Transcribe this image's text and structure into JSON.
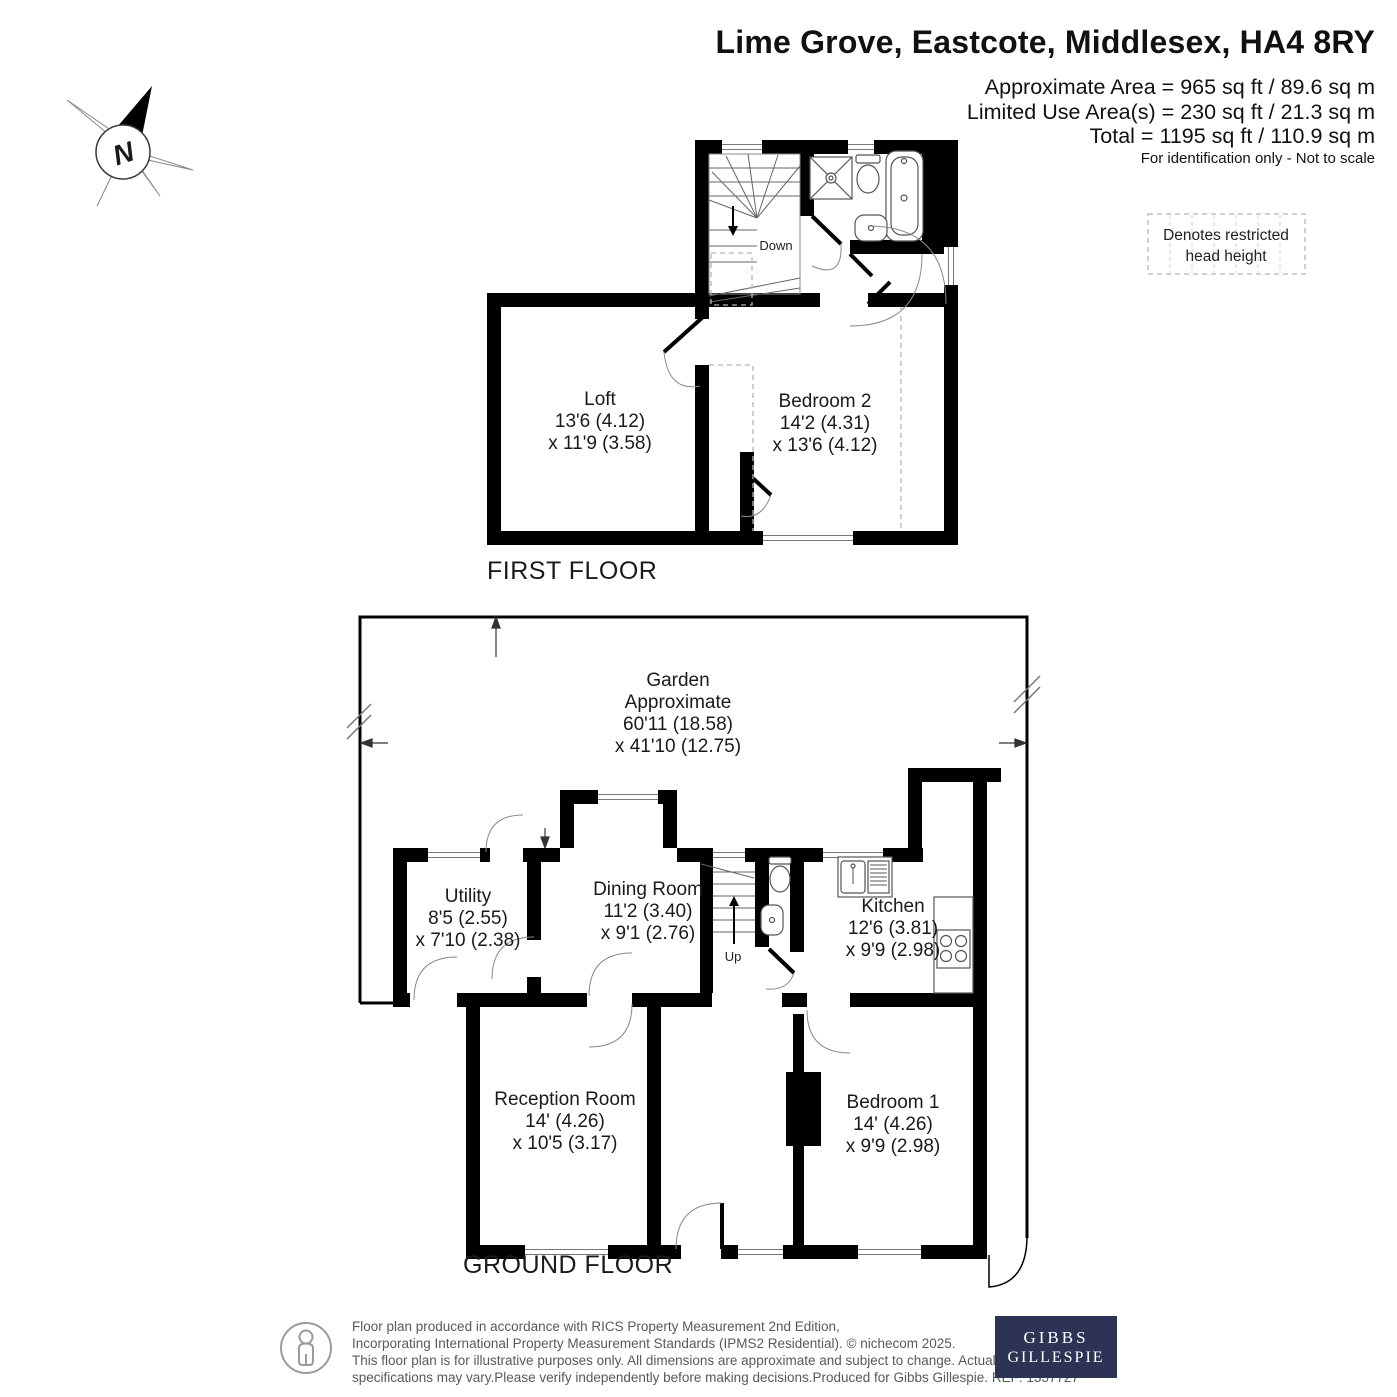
{
  "header": {
    "title": "Lime Grove, Eastcote, Middlesex, HA4 8RY",
    "area_line1": "Approximate Area = 965 sq ft / 89.6 sq m",
    "area_line2": "Limited Use Area(s) = 230 sq ft / 21.3 sq m",
    "area_line3": "Total = 1195 sq ft / 110.9 sq m",
    "disclaimer": "For identification only - Not to scale"
  },
  "legend": {
    "line1": "Denotes restricted",
    "line2": "head height"
  },
  "compass": {
    "north_label": "N"
  },
  "floors": {
    "first": {
      "label": "FIRST FLOOR",
      "stair_label": "Down",
      "rooms": {
        "loft": {
          "name": "Loft",
          "d1": "13'6 (4.12)",
          "d2": "x 11'9 (3.58)"
        },
        "bedroom2": {
          "name": "Bedroom 2",
          "d1": "14'2 (4.31)",
          "d2": "x 13'6 (4.12)"
        }
      }
    },
    "ground": {
      "label": "GROUND FLOOR",
      "stair_label": "Up",
      "garden": {
        "name": "Garden",
        "l2": "Approximate",
        "d1": "60'11 (18.58)",
        "d2": "x 41'10 (12.75)"
      },
      "rooms": {
        "utility": {
          "name": "Utility",
          "d1": "8'5 (2.55)",
          "d2": "x 7'10 (2.38)"
        },
        "dining": {
          "name": "Dining Room",
          "d1": "11'2 (3.40)",
          "d2": "x 9'1 (2.76)"
        },
        "kitchen": {
          "name": "Kitchen",
          "d1": "12'6 (3.81)",
          "d2": "x 9'9 (2.98)"
        },
        "reception": {
          "name": "Reception Room",
          "d1": "14' (4.26)",
          "d2": "x 10'5 (3.17)"
        },
        "bedroom1": {
          "name": "Bedroom 1",
          "d1": "14' (4.26)",
          "d2": "x 9'9 (2.98)"
        }
      }
    }
  },
  "footer": {
    "line1": "Floor plan produced in accordance with RICS Property Measurement 2nd Edition,",
    "line2": "Incorporating International Property Measurement Standards (IPMS2 Residential).   © nichecom 2025.",
    "line3": "This floor plan is for illustrative purposes only. All dimensions are approximate and subject to change. Actual layout, features and",
    "line4": "specifications may vary.Please verify independently before making decisions.Produced for Gibbs Gillespie.   REF: 1357727",
    "logo_line1": "GIBBS",
    "logo_line2": "GILLESPIE"
  },
  "colors": {
    "wall": "#000000",
    "logo_bg": "#2c3354",
    "footer_text": "#58595b"
  }
}
